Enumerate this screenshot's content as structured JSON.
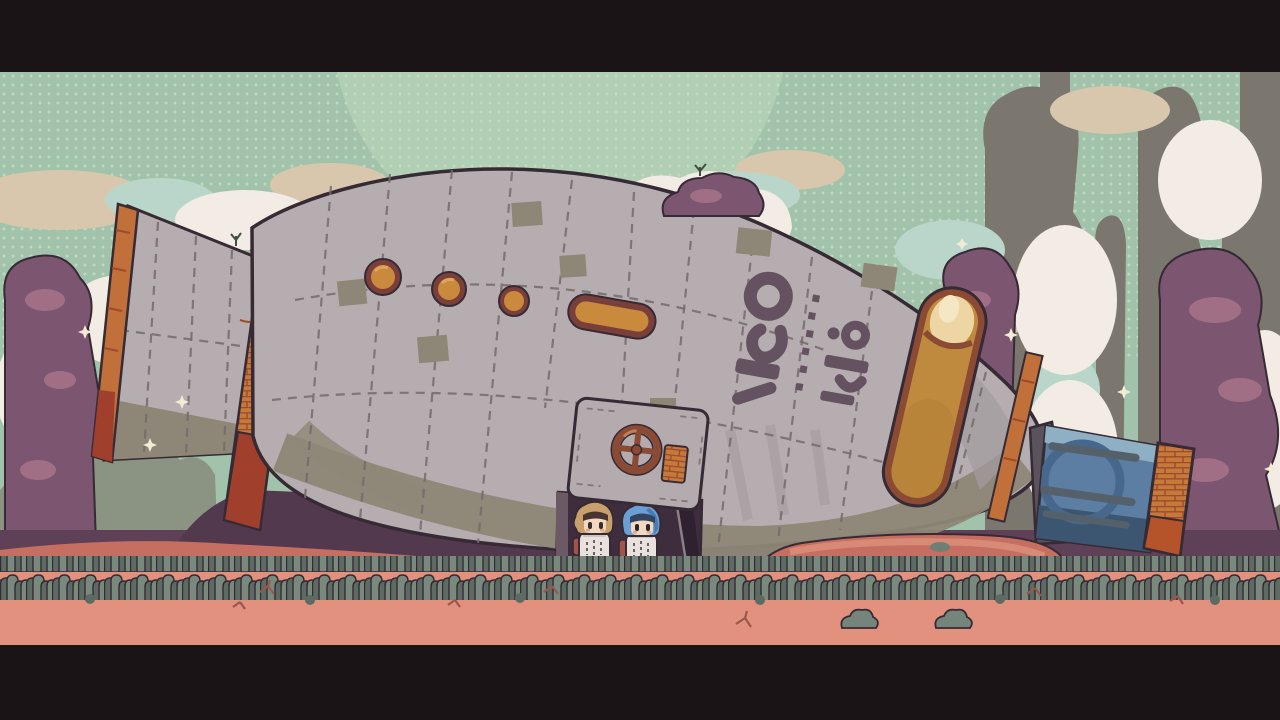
{
  "meta": {
    "type": "game-screenshot",
    "description": "Pixel-art side-view scene: a large crashed rocket ship lying on an alien planet surface, two small astronaut characters standing in its open hatch doorway, letterboxed with black cinematic bars"
  },
  "palette": {
    "letterbox": "#1b1417",
    "sky": "#a2c3ab",
    "skyDot": "#cbdcc1",
    "moon": "#b3d0b5",
    "cloudCream": "#f3ece4",
    "cloudTan": "#d8c7ac",
    "cloudTeal": "#bad6ca",
    "pillarGray": "#7b776f",
    "bushGreen": "#8b9383",
    "rockPurple": "#7c5570",
    "rockPurpleLight": "#a06f85",
    "rockPurpleDark": "#63445c",
    "shadowPurple": "#5e4156",
    "shadowDeep": "#53394e",
    "dirtRed": "#c66e62",
    "dirtSalmon": "#d98a77",
    "groundPink": "#e2917e",
    "grassLight": "#79897d",
    "grassDark": "#5c6c63",
    "outline": "#362a35",
    "hull": "#b5adaf",
    "hullShade": "#a39ba0",
    "hullPatch": "#8e8777",
    "hullSeam": "#756a6d",
    "trimOrange": "#c07038",
    "trimOrangeDark": "#9d4a2e",
    "brickOrange": "#c57a3a",
    "rust": "#a03f2c",
    "glassAmber": "#c08a3e",
    "glassAmberLight": "#eed5a4",
    "glassGlow": "#f6e7c4",
    "portholeRim": "#7a3f38",
    "portholeGlass": "#c98a3e",
    "doorGray": "#b3abad",
    "doorwayDark": "#3e2d3c",
    "doorwayDeep": "#2f2230",
    "wheelRust": "#8a4a33",
    "noseBlue": "#5c7ea2",
    "noseBlueLight": "#8fb0c4",
    "noseBlueDark": "#3c5571",
    "noseEmblem": "#47688c",
    "nosePipe": "#54616b",
    "glyph": "#645260",
    "sparkle": "#f2ecd5",
    "hairTan": "#c9a06b",
    "hairBlue": "#6b9fd4",
    "fringeDark": "#4a3432",
    "fringeNavy": "#33455e",
    "skin": "#f2d8bf",
    "suitWhite": "#e9e1dd",
    "suitShade": "#cfc5c0",
    "packRed": "#a4524a",
    "twig": "#99574d"
  },
  "scene": {
    "label": "Pixel-art alien planet scene with crashed rocket ship and two astronauts",
    "sky": {
      "style": "dotted halftone sky",
      "moon_visible": true
    },
    "ship": {
      "label": "crashed rocket ship",
      "features": [
        "flared tail fin with orange leading edge",
        "orange brick engine nozzle",
        "three round amber portholes",
        "oval amber window",
        "alien stencil markings on hull",
        "large amber glass capsule window",
        "round hatch door with rust wheel and orange latch",
        "open dark doorway",
        "blue nose section with circular emblem and pipes",
        "orange brick nose cap"
      ]
    },
    "door": {
      "label": "open hatch doorway"
    },
    "hatch_wheel": {
      "label": "hatch wheel"
    },
    "characters": [
      {
        "label": "astronaut with tan hair and white suit",
        "position": "left in doorway"
      },
      {
        "label": "astronaut with blue hair and white suit",
        "position": "right in doorway"
      }
    ],
    "environment": [
      "purple rock formations",
      "grey rock pillars",
      "cream and teal clouds",
      "grey-green bushes",
      "grass strip",
      "pink ground with twigs",
      "two small rock clusters",
      "cream sparkles"
    ]
  }
}
